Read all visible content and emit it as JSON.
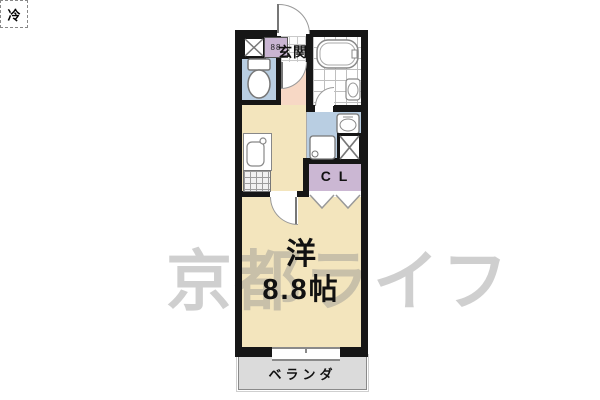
{
  "watermark": {
    "text": "京都ライフ",
    "color": "#8f8f8f"
  },
  "labels": {
    "genkan": "玄関",
    "fridge": "冷",
    "meter": "88",
    "closet": "C L",
    "room_type": "洋",
    "room_size": "8.8帖",
    "veranda": "ベランダ"
  },
  "rooms": [
    {
      "id": "genkan",
      "label": "玄関",
      "floor": "tile-and-salmon"
    },
    {
      "id": "toilet",
      "label": "",
      "floor": "light-blue",
      "fixture": "toilet"
    },
    {
      "id": "bathroom",
      "label": "",
      "floor": "white-tile",
      "fixtures": [
        "bathtub",
        "washbasin"
      ]
    },
    {
      "id": "kitchen",
      "label": "",
      "floor": "beige",
      "fixtures": [
        "refrigerator-space",
        "sink",
        "stove"
      ]
    },
    {
      "id": "washroom",
      "label": "",
      "floor": "light-blue",
      "fixtures": [
        "vanity",
        "washer-pan",
        "pipe-space"
      ]
    },
    {
      "id": "closet",
      "label": "C L",
      "floor": "purple",
      "door": "folding"
    },
    {
      "id": "main-room",
      "label": "洋 8.8帖",
      "floor": "beige"
    },
    {
      "id": "veranda",
      "label": "ベランダ",
      "floor": "gray"
    }
  ],
  "colors": {
    "wall": "#161616",
    "room_beige": "#f3e5bd",
    "entry_salmon": "#f7d8c5",
    "water_blue": "#b9cee2",
    "closet_purple": "#cbb7d3",
    "meter_purple": "#c9b5d2",
    "veranda_gray": "#dbdbdb",
    "watermark_gray": "#8f8f8f"
  }
}
